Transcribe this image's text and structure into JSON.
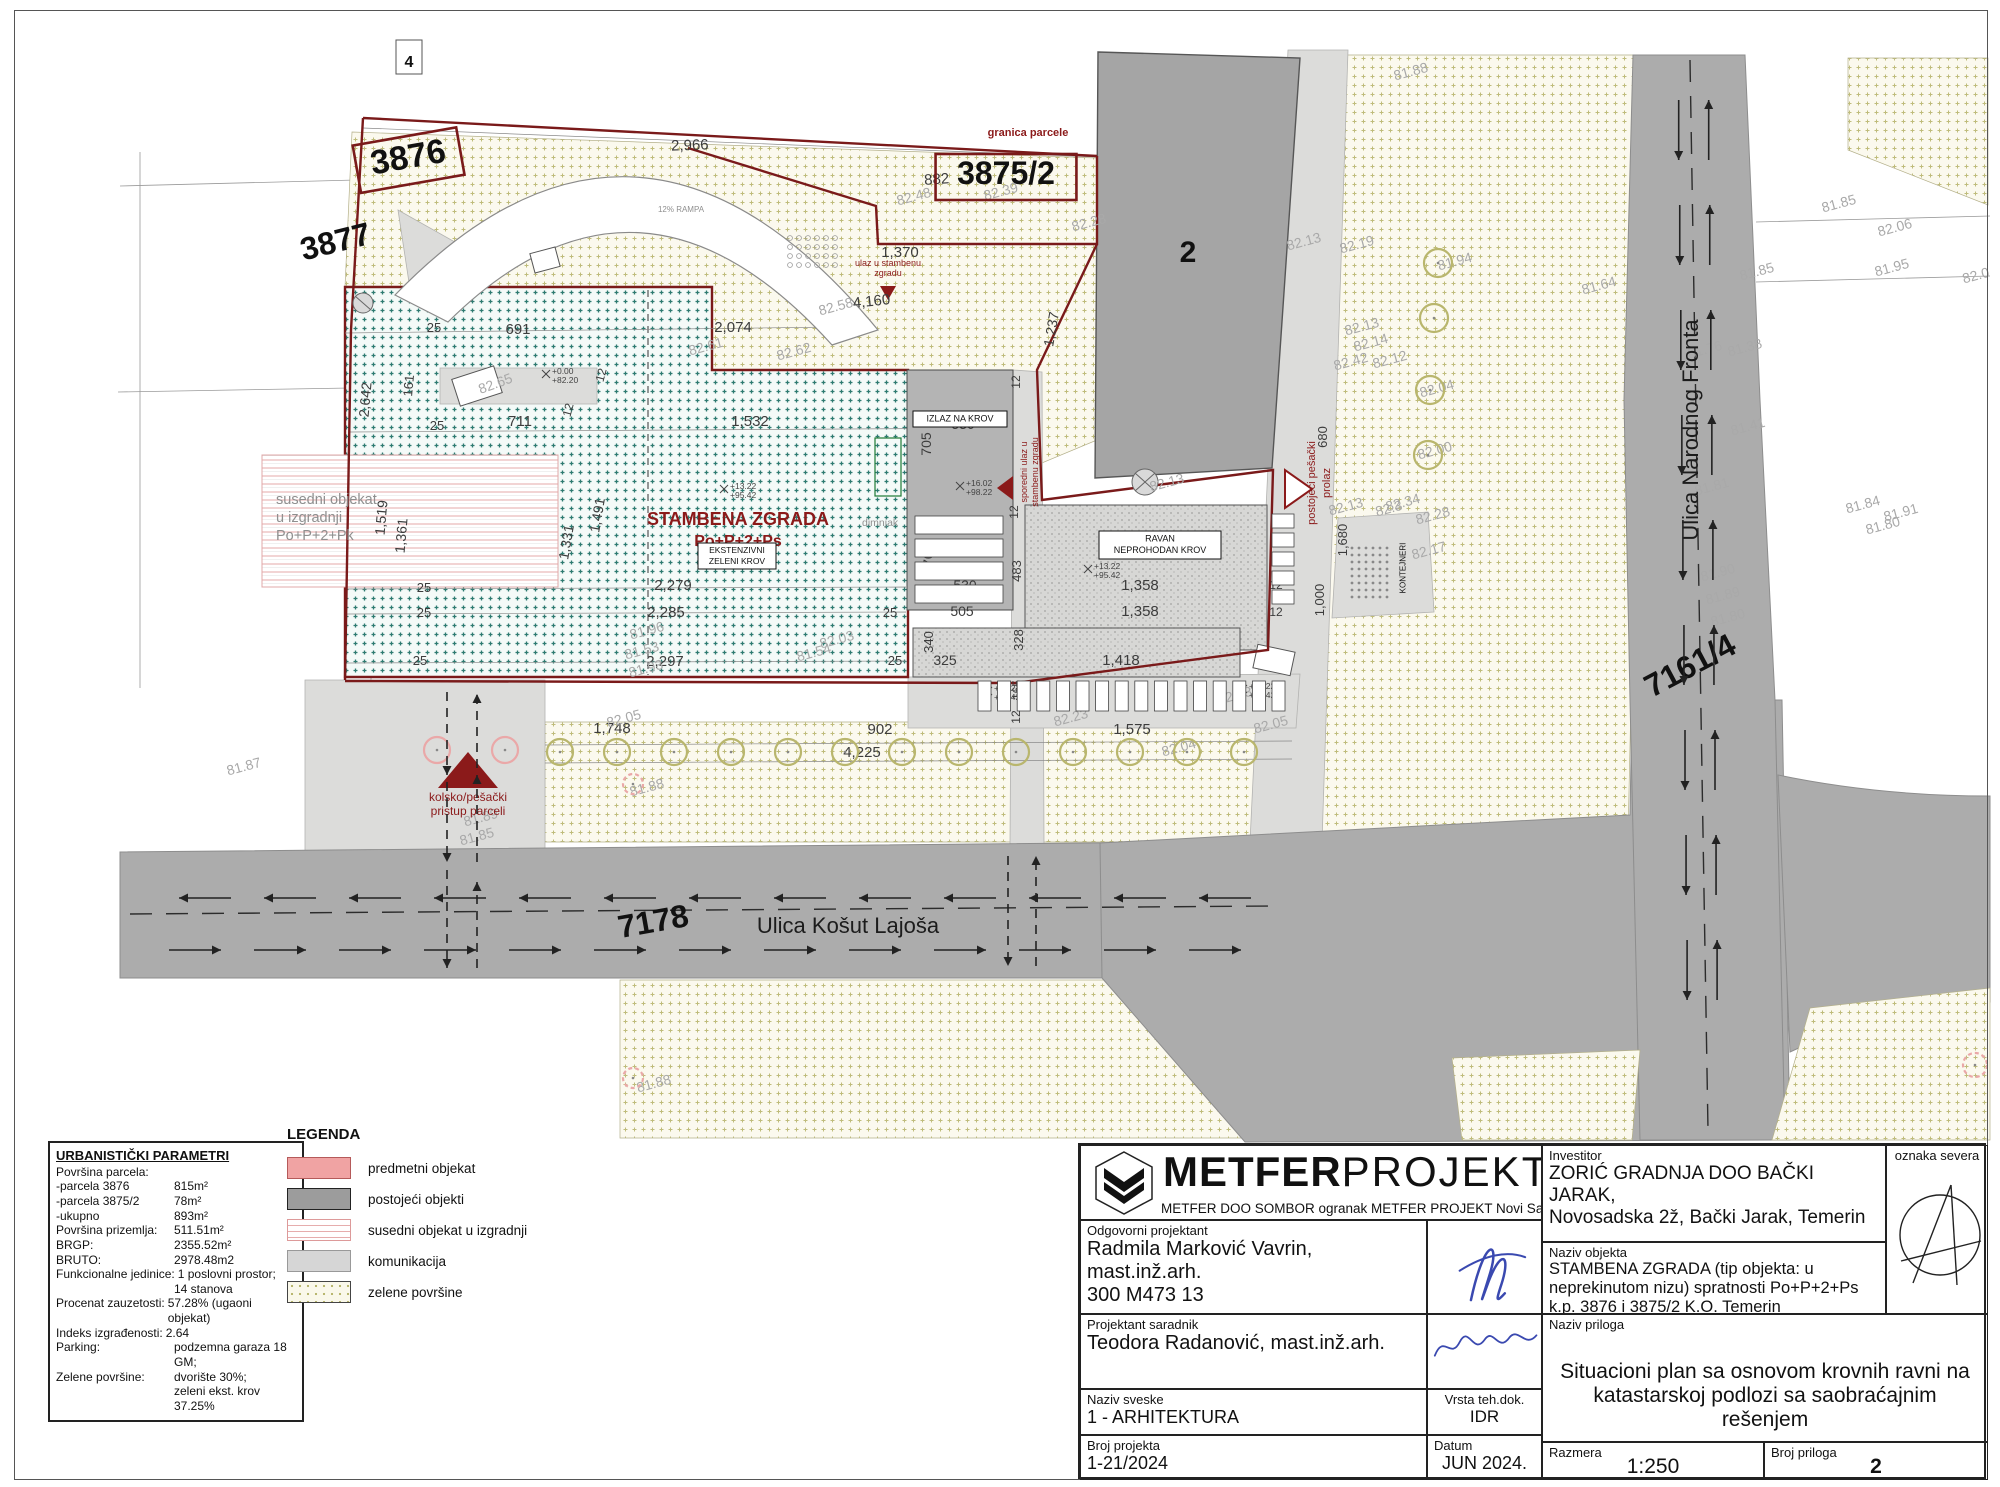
{
  "colors": {
    "boundary_red": "#7a1a1a",
    "annotation_red": "#8b1a1a",
    "roof_teal": "#2e7b71",
    "road_gray": "#acacac",
    "green_olive": "#b5b267",
    "signature_blue": "#3a49b0"
  },
  "legend": {
    "title": "LEGENDA",
    "items": [
      {
        "label": "predmetni objekat",
        "k": "pink"
      },
      {
        "label": "postojeći objekti",
        "k": "dark"
      },
      {
        "label": "susedni objekat u izgradnji",
        "k": "lines"
      },
      {
        "label": "komunikacija",
        "k": "light"
      },
      {
        "label": "zelene površine",
        "k": "dots"
      }
    ]
  },
  "params": {
    "title": "URBANISTIČKI PARAMETRI",
    "rows": [
      {
        "l": "Površina parcela:",
        "v": ""
      },
      {
        "l": "-parcela 3876",
        "v": "815m²"
      },
      {
        "l": "-parcela 3875/2",
        "v": "78m²"
      },
      {
        "l": "-ukupno",
        "v": "893m²"
      },
      {
        "l": "Površina prizemlja:",
        "v": "511.51m²"
      },
      {
        "l": "BRGP:",
        "v": "2355.52m²"
      },
      {
        "l": "BRUTO:",
        "v": "2978.48m2"
      },
      {
        "l": "Funkcionalne jedinice:",
        "v": "1 poslovni prostor;",
        "w": 1
      },
      {
        "l": "",
        "v": "14 stanova"
      },
      {
        "l": "Procenat zauzetosti:",
        "v": "57.28% (ugaoni objekat)",
        "w": 1
      },
      {
        "l": "Indeks izgrađenosti:",
        "v": "2.64",
        "w": 1
      },
      {
        "l": "Parking:",
        "v": "podzemna garaza 18 GM;"
      },
      {
        "l": "Zelene površine:",
        "v": "dvorište 30%;"
      },
      {
        "l": "",
        "v": "zeleni ekst. krov 37.25%"
      }
    ]
  },
  "titleblock": {
    "brand_bold": "METFER",
    "brand_light": "PROJEKT",
    "tagline": "METFER DOO SOMBOR ogranak METFER PROJEKT Novi Sad",
    "investor": {
      "label": "Investitor",
      "line1": "ZORIĆ GRADNJA DOO BAČKI JARAK,",
      "line2": "Novosadska 2ž, Bački Jarak, Temerin"
    },
    "odg": {
      "label": "Odgovorni projektant",
      "line1": "Radmila Marković Vavrin,",
      "line2": "mast.inž.arh.",
      "line3": "300 M473 13"
    },
    "objekt": {
      "label": "Naziv objekta",
      "line1": "STAMBENA ZGRADA (tip objekta: u",
      "line2": "neprekinutom nizu) spratnosti Po+P+2+Ps",
      "line3": "k.p. 3876 i 3875/2 K.O. Temerin"
    },
    "sever": {
      "label": "oznaka severa"
    },
    "sar": {
      "label": "Projektant saradnik",
      "line1": "Teodora Radanović, mast.inž.arh."
    },
    "priloga": {
      "label": "Naziv priloga",
      "line1": "Situacioni plan sa osnovom krovnih ravni na",
      "line2": "katastarskoj podlozi sa saobraćajnim rešenjem"
    },
    "sveske": {
      "label": "Naziv sveske",
      "value": "1 - ARHITEKTURA"
    },
    "vrsta": {
      "label": "Vrsta teh.dok.",
      "value": "IDR"
    },
    "broj": {
      "label": "Broj projekta",
      "value": "1-21/2024"
    },
    "datum": {
      "label": "Datum",
      "value": "JUN 2024."
    },
    "razmera": {
      "label": "Razmera",
      "value": "1:250"
    },
    "prilog": {
      "label": "Broj priloga",
      "value": "2"
    }
  },
  "plan": {
    "street_labels": [
      {
        "t": "Ulica Košut Lajoša",
        "x": 848,
        "y": 933,
        "s": 22
      },
      {
        "t": "Ulica Narodnog Fronta",
        "x": 1698,
        "y": 430,
        "s": 22,
        "r": -90
      }
    ],
    "parcel_labels": [
      {
        "t": "3876",
        "x": 410,
        "y": 168,
        "s": 34,
        "r": -10,
        "box": 1
      },
      {
        "t": "3875/2",
        "x": 1006,
        "y": 184,
        "s": 32,
        "box": 1
      },
      {
        "t": "3877",
        "x": 338,
        "y": 252,
        "s": 32,
        "r": -14
      },
      {
        "t": "2",
        "x": 1188,
        "y": 262,
        "s": 30
      },
      {
        "t": "7178",
        "x": 655,
        "y": 932,
        "s": 32,
        "r": -10
      },
      {
        "t": "7161/4",
        "x": 1695,
        "y": 675,
        "s": 32,
        "r": -28
      },
      {
        "t": "4",
        "x": 409,
        "y": 67,
        "s": 16
      }
    ],
    "red_labels": [
      {
        "t": "granica parcele",
        "x": 1028,
        "y": 136,
        "s": 11,
        "b": 1
      },
      {
        "t": "ulaz u stambenu",
        "x": 888,
        "y": 266,
        "s": 9
      },
      {
        "t": "zgradu",
        "x": 888,
        "y": 276,
        "s": 9
      },
      {
        "t": "sporedni ulaz u",
        "x": 1027,
        "y": 472,
        "s": 9,
        "r": -90
      },
      {
        "t": "stambenu zgradu",
        "x": 1038,
        "y": 472,
        "s": 9,
        "r": -90
      },
      {
        "t": "postojeći pešački",
        "x": 1315,
        "y": 483,
        "s": 11,
        "r": -90
      },
      {
        "t": "prolaz",
        "x": 1330,
        "y": 483,
        "s": 11,
        "r": -90
      },
      {
        "t": "kolsko/pešački",
        "x": 468,
        "y": 801,
        "s": 12
      },
      {
        "t": "pristup parceli",
        "x": 468,
        "y": 815,
        "s": 12
      },
      {
        "t": "STAMBENA ZGRADA",
        "x": 738,
        "y": 525,
        "s": 18,
        "b": 1
      },
      {
        "t": "Po+P+2+Ps",
        "x": 738,
        "y": 546,
        "s": 16,
        "b": 1
      }
    ],
    "gray_labels": [
      {
        "t": "dimnjak",
        "x": 862,
        "y": 526,
        "s": 10.5,
        "a": "s"
      },
      {
        "t": "susedni objekat",
        "x": 276,
        "y": 504,
        "s": 14.5,
        "a": "s"
      },
      {
        "t": "u izgradnji",
        "x": 276,
        "y": 522,
        "s": 14.5,
        "a": "s"
      },
      {
        "t": "Po+P+2+Pk",
        "x": 276,
        "y": 540,
        "s": 14.5,
        "a": "s"
      },
      {
        "t": "12% RAMPA",
        "x": 681,
        "y": 212,
        "s": 8
      }
    ],
    "box_labels": [
      {
        "lines": [
          "IZLAZ NA KROV"
        ],
        "x": 960,
        "y": 419,
        "w": 94,
        "h": 16,
        "s": 9
      },
      {
        "lines": [
          "RAVAN",
          "NEPROHODAN KROV"
        ],
        "x": 1160,
        "y": 545,
        "w": 122,
        "h": 28,
        "s": 9
      },
      {
        "lines": [
          "EKSTENZIVNI",
          "ZELENI KROV"
        ],
        "x": 737,
        "y": 556,
        "w": 78,
        "h": 26,
        "s": 8.5
      },
      {
        "lines": [
          "KONTEJNERI"
        ],
        "x": 1396,
        "y": 568,
        "w": 0,
        "h": 0,
        "s": 8,
        "r": -90,
        "nobox": 1
      }
    ],
    "dims": [
      {
        "t": "2,966",
        "x": 690,
        "y": 150,
        "s": 15,
        "r": -2
      },
      {
        "t": "882",
        "x": 937,
        "y": 184,
        "s": 15,
        "r": -4
      },
      {
        "t": "4,160",
        "x": 872,
        "y": 306,
        "s": 15,
        "r": -6
      },
      {
        "t": "2,074",
        "x": 733,
        "y": 332,
        "s": 15
      },
      {
        "t": "691",
        "x": 518,
        "y": 334,
        "s": 15
      },
      {
        "t": "25",
        "x": 434,
        "y": 332,
        "s": 13
      },
      {
        "t": "25",
        "x": 437,
        "y": 430,
        "s": 13
      },
      {
        "t": "1,532",
        "x": 750,
        "y": 426,
        "s": 15
      },
      {
        "t": "711",
        "x": 520,
        "y": 426,
        "s": 15
      },
      {
        "t": "12",
        "x": 572,
        "y": 411,
        "s": 12,
        "r": -75
      },
      {
        "t": "12",
        "x": 605,
        "y": 376,
        "s": 12,
        "r": -75
      },
      {
        "t": "1,237",
        "x": 1056,
        "y": 330,
        "s": 14,
        "r": -80
      },
      {
        "t": "705",
        "x": 931,
        "y": 444,
        "s": 14,
        "r": -90
      },
      {
        "t": "530",
        "x": 963,
        "y": 429,
        "s": 14
      },
      {
        "t": "470",
        "x": 933,
        "y": 563,
        "s": 14,
        "r": -90
      },
      {
        "t": "530",
        "x": 965,
        "y": 590,
        "s": 14
      },
      {
        "t": "505",
        "x": 962,
        "y": 616,
        "s": 14
      },
      {
        "t": "483",
        "x": 1021,
        "y": 571,
        "s": 13,
        "r": -90
      },
      {
        "t": "12",
        "x": 1020,
        "y": 382,
        "s": 12,
        "r": -90
      },
      {
        "t": "12",
        "x": 1018,
        "y": 512,
        "s": 12,
        "r": -90
      },
      {
        "t": "1,358",
        "x": 1140,
        "y": 590,
        "s": 15
      },
      {
        "t": "1,358",
        "x": 1140,
        "y": 616,
        "s": 15
      },
      {
        "t": "12",
        "x": 1276,
        "y": 589,
        "s": 12
      },
      {
        "t": "12",
        "x": 1276,
        "y": 616,
        "s": 12
      },
      {
        "t": "1,000",
        "x": 1324,
        "y": 600,
        "s": 13,
        "r": -90
      },
      {
        "t": "680",
        "x": 1327,
        "y": 437,
        "s": 13,
        "r": -90
      },
      {
        "t": "1,680",
        "x": 1347,
        "y": 540,
        "s": 13,
        "r": -90
      },
      {
        "t": "1,491",
        "x": 602,
        "y": 516,
        "s": 14,
        "r": -80
      },
      {
        "t": "1,331",
        "x": 571,
        "y": 543,
        "s": 14,
        "r": -80
      },
      {
        "t": "2,279",
        "x": 673,
        "y": 590,
        "s": 15
      },
      {
        "t": "2,285",
        "x": 666,
        "y": 617,
        "s": 15
      },
      {
        "t": "2,297",
        "x": 665,
        "y": 666,
        "s": 15
      },
      {
        "t": "25",
        "x": 424,
        "y": 592,
        "s": 13
      },
      {
        "t": "25",
        "x": 424,
        "y": 617,
        "s": 13
      },
      {
        "t": "25",
        "x": 420,
        "y": 665,
        "s": 13
      },
      {
        "t": "25",
        "x": 890,
        "y": 617,
        "s": 13
      },
      {
        "t": "25",
        "x": 895,
        "y": 665,
        "s": 13
      },
      {
        "t": "340",
        "x": 933,
        "y": 642,
        "s": 13,
        "r": -90
      },
      {
        "t": "325",
        "x": 945,
        "y": 665,
        "s": 14
      },
      {
        "t": "328",
        "x": 1023,
        "y": 640,
        "s": 13,
        "r": -90
      },
      {
        "t": "1,418",
        "x": 1121,
        "y": 665,
        "s": 15
      },
      {
        "t": "165",
        "x": 1021,
        "y": 690,
        "s": 12,
        "r": -90
      },
      {
        "t": "12",
        "x": 1020,
        "y": 717,
        "s": 12,
        "r": -90
      },
      {
        "t": "1,748",
        "x": 612,
        "y": 733,
        "s": 15
      },
      {
        "t": "902",
        "x": 880,
        "y": 734,
        "s": 15
      },
      {
        "t": "1,575",
        "x": 1132,
        "y": 734,
        "s": 15
      },
      {
        "t": "4,225",
        "x": 862,
        "y": 757,
        "s": 15
      },
      {
        "t": "2,642",
        "x": 370,
        "y": 400,
        "s": 14,
        "r": -85
      },
      {
        "t": "161",
        "x": 413,
        "y": 386,
        "s": 13,
        "r": -85
      },
      {
        "t": "1,519",
        "x": 386,
        "y": 518,
        "s": 14,
        "r": -85
      },
      {
        "t": "1,361",
        "x": 406,
        "y": 536,
        "s": 14,
        "r": -85
      },
      {
        "t": "1,370",
        "x": 900,
        "y": 257,
        "s": 15
      }
    ],
    "elevations": [
      {
        "t": "82.48",
        "x": 915,
        "y": 201
      },
      {
        "t": "82.39",
        "x": 1002,
        "y": 196
      },
      {
        "t": "82.28",
        "x": 1090,
        "y": 227
      },
      {
        "t": "82.13",
        "x": 1305,
        "y": 246
      },
      {
        "t": "82.19",
        "x": 1358,
        "y": 249
      },
      {
        "t": "81.94",
        "x": 1456,
        "y": 266
      },
      {
        "t": "81.88",
        "x": 1412,
        "y": 76
      },
      {
        "t": "82.13",
        "x": 1363,
        "y": 331
      },
      {
        "t": "82.14",
        "x": 1372,
        "y": 347
      },
      {
        "t": "82.12",
        "x": 1391,
        "y": 364
      },
      {
        "t": "82.42",
        "x": 1352,
        "y": 366
      },
      {
        "t": "82.04",
        "x": 1438,
        "y": 393
      },
      {
        "t": "82.00",
        "x": 1436,
        "y": 455
      },
      {
        "t": "82.34",
        "x": 1404,
        "y": 507
      },
      {
        "t": "82.28",
        "x": 1434,
        "y": 520
      },
      {
        "t": "82.17",
        "x": 1430,
        "y": 555
      },
      {
        "t": "82.13",
        "x": 1347,
        "y": 511
      },
      {
        "t": "82.3",
        "x": 1390,
        "y": 513
      },
      {
        "t": "81.64",
        "x": 1600,
        "y": 290
      },
      {
        "t": "81.85",
        "x": 1758,
        "y": 276
      },
      {
        "t": "81.85",
        "x": 1840,
        "y": 208
      },
      {
        "t": "82.06",
        "x": 1896,
        "y": 232
      },
      {
        "t": "81.95",
        "x": 1893,
        "y": 272
      },
      {
        "t": "82.0",
        "x": 1977,
        "y": 280
      },
      {
        "t": "81.76",
        "x": 1706,
        "y": 354
      },
      {
        "t": "81.38",
        "x": 1746,
        "y": 352
      },
      {
        "t": "81.41",
        "x": 1749,
        "y": 431
      },
      {
        "t": "81.81",
        "x": 1713,
        "y": 491
      },
      {
        "t": "81.84",
        "x": 1864,
        "y": 509
      },
      {
        "t": "81.91",
        "x": 1902,
        "y": 517
      },
      {
        "t": "81.80",
        "x": 1884,
        "y": 530
      },
      {
        "t": "81.90",
        "x": 1719,
        "y": 577
      },
      {
        "t": "81.89",
        "x": 1724,
        "y": 600
      },
      {
        "t": "81.80",
        "x": 1729,
        "y": 622
      },
      {
        "t": "82.58",
        "x": 837,
        "y": 311
      },
      {
        "t": "82.61",
        "x": 707,
        "y": 351
      },
      {
        "t": "82.62",
        "x": 795,
        "y": 356
      },
      {
        "t": "82.23",
        "x": 1072,
        "y": 722
      },
      {
        "t": "82.13",
        "x": 1236,
        "y": 700
      },
      {
        "t": "82.05",
        "x": 1272,
        "y": 729
      },
      {
        "t": "81.96",
        "x": 648,
        "y": 635
      },
      {
        "t": "81.53",
        "x": 643,
        "y": 655
      },
      {
        "t": "81.93",
        "x": 647,
        "y": 673
      },
      {
        "t": "82.03",
        "x": 838,
        "y": 644
      },
      {
        "t": "81.54",
        "x": 815,
        "y": 657
      },
      {
        "t": "81.89",
        "x": 482,
        "y": 822
      },
      {
        "t": "81.85",
        "x": 478,
        "y": 841
      },
      {
        "t": "81.88",
        "x": 648,
        "y": 792
      },
      {
        "t": "81.87",
        "x": 245,
        "y": 771
      },
      {
        "t": "82.65",
        "x": 497,
        "y": 388,
        "r": -20
      },
      {
        "t": "82.13",
        "x": 1168,
        "y": 487
      },
      {
        "t": "81.88",
        "x": 655,
        "y": 1088
      },
      {
        "t": "82.05",
        "x": 625,
        "y": 723
      },
      {
        "t": "82.04",
        "x": 1180,
        "y": 752
      }
    ],
    "spots": [
      {
        "a": "+16.02",
        "b": "+98.22",
        "x": 962,
        "y": 487
      },
      {
        "a": "+13.22",
        "b": "+95.42",
        "x": 1090,
        "y": 570
      },
      {
        "a": "+13.22",
        "b": "+95.42",
        "x": 990,
        "y": 692
      },
      {
        "a": "+13.22",
        "b": "+95.42",
        "x": 1245,
        "y": 690
      },
      {
        "a": "+13.22",
        "b": "+95.42",
        "x": 726,
        "y": 490
      },
      {
        "a": "+0.00",
        "b": "+82.20",
        "x": 548,
        "y": 375
      }
    ]
  }
}
